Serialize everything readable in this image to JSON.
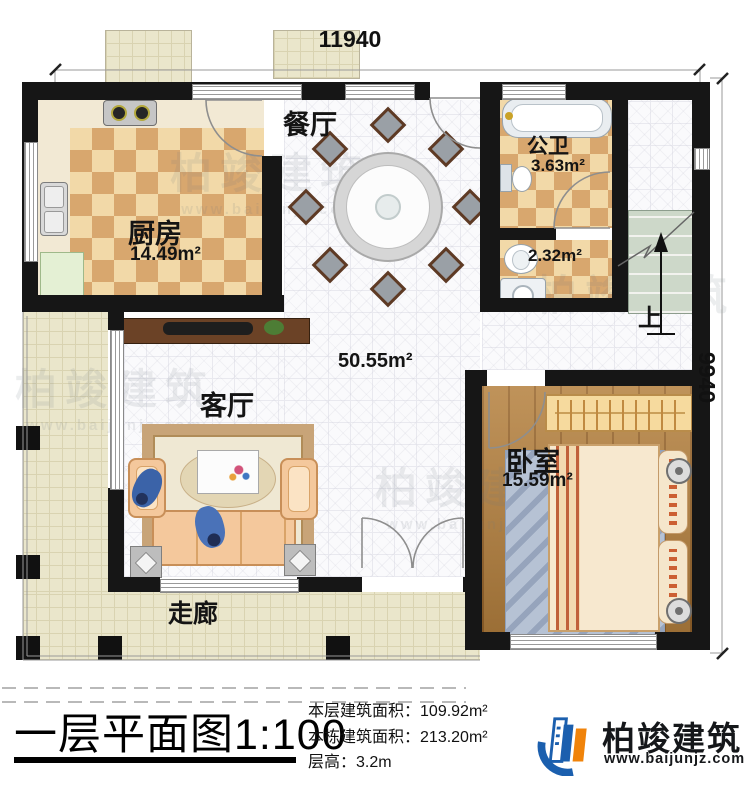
{
  "dimensions": {
    "width_label": "11940",
    "height_label": "9940"
  },
  "rooms": {
    "kitchen": {
      "name": "厨房",
      "area": "14.49m²"
    },
    "dining": {
      "name": "餐厅"
    },
    "bath": {
      "name": "公卫",
      "area": "3.63m²"
    },
    "washroom": {
      "area": "2.32m²"
    },
    "hall": {
      "area": "50.55m²"
    },
    "living": {
      "name": "客厅"
    },
    "bedroom": {
      "name": "卧室",
      "area": "15.59m²"
    },
    "corridor": {
      "name": "走廊"
    },
    "stairs": {
      "up_label": "上"
    }
  },
  "title_block": {
    "title": "一层平面图",
    "scale": "1:100",
    "stats": [
      {
        "label": "本层建筑面积：",
        "value": "109.92m²"
      },
      {
        "label": "本栋建筑面积：",
        "value": "213.20m²"
      },
      {
        "label": "层高：",
        "value": "3.2m"
      }
    ],
    "brand": {
      "name": "柏竣建筑",
      "website": "www.baijunjz.com"
    }
  },
  "watermark": {
    "text": "柏竣建筑",
    "website": "www.baijunjz.com"
  },
  "colors": {
    "wall": "#161616",
    "checker_light": "#f2d9a8",
    "checker_dark": "#d8a76e",
    "beige_tile": "#eae6cb",
    "wood": "#b5813f",
    "brand_blue": "#1b5fae",
    "brand_orange": "#f0830a"
  }
}
